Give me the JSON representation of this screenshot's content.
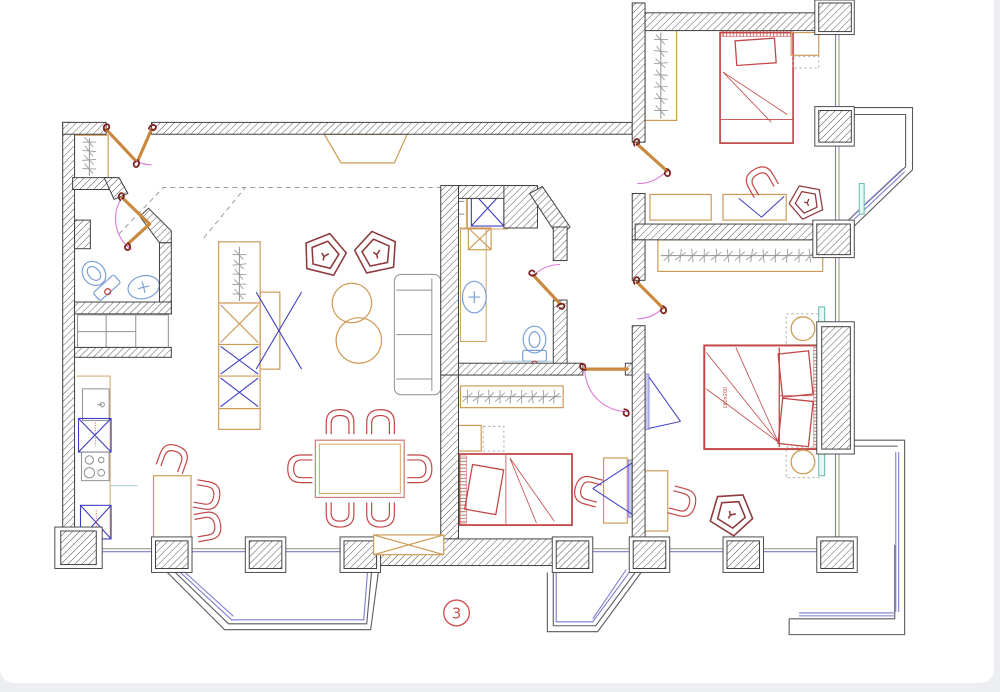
{
  "sheet": {
    "marker": "3"
  },
  "annotations": {
    "master_bed_size": "160x200"
  },
  "palette": {
    "wall": "#3f3f3f",
    "furniture_wood": "#cd9a55",
    "furniture_red": "#c24646",
    "furniture_dark_red": "#8e3b3f",
    "fixtures_blue": "#7b9fd4",
    "appliance_x": "#3b3bc4",
    "door_arc_magenta": "#de7ad8",
    "door_leaf": "#c9893f",
    "window_glass": "#7b7bd0",
    "bay_outline": "#5a5a5a",
    "radiator_teal": "#5fb8b0",
    "marker_red": "#d05050"
  },
  "symbols": {
    "wall_fill": "diagonal-hatch",
    "door": "leaf-with-swing-arc",
    "window": "double-blue-line",
    "bay_window": "gray-double-outline",
    "wardrobe": "rail-with-hangers",
    "appliance": "box-with-x-cross",
    "sink": "oval-with-cross",
    "toilet": "bowl-with-tank"
  }
}
